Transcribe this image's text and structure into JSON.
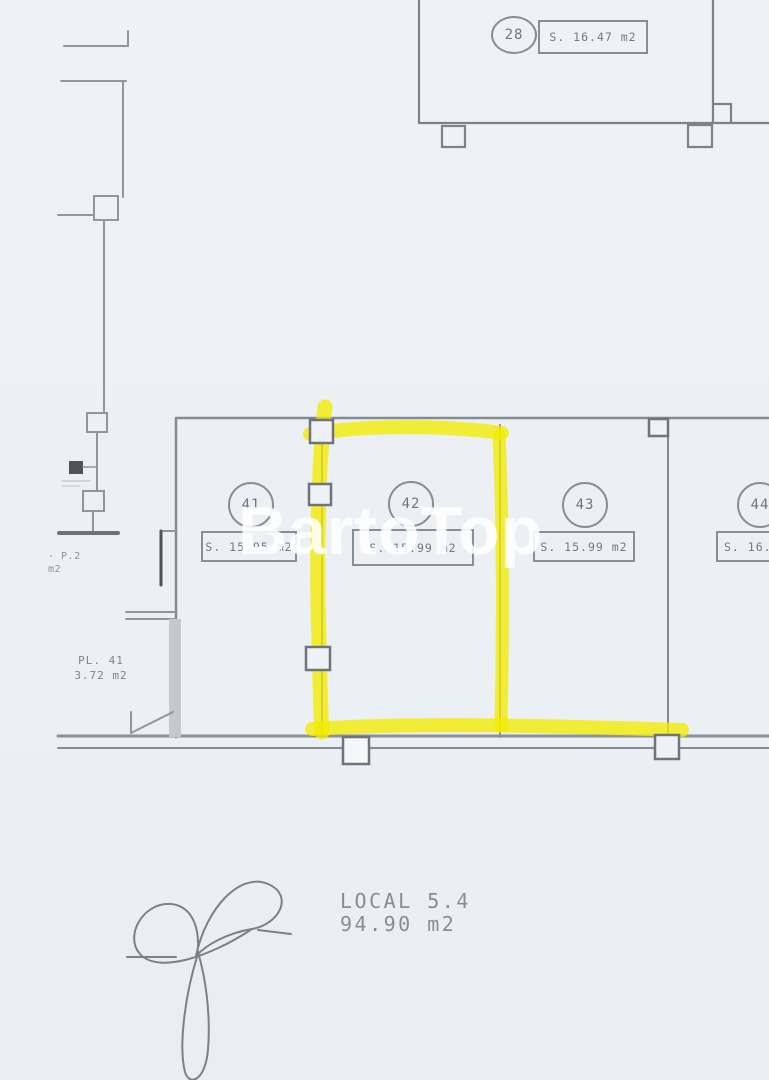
{
  "page": {
    "type": "scanned floor plan",
    "background_color": "#edf1f5",
    "line_color": "#8f969c",
    "highlight_color": "#f2ee00"
  },
  "watermark": {
    "text": "BartoTop"
  },
  "top_unit": {
    "number": "28",
    "area": "S. 16.47 m2"
  },
  "units": [
    {
      "number": "41",
      "area": "S. 15.95 m2",
      "highlighted": false
    },
    {
      "number": "42",
      "area": "S. 15.99 m2",
      "highlighted": true
    },
    {
      "number": "43",
      "area": "S. 15.99 m2",
      "highlighted": false
    },
    {
      "number": "44",
      "area": "S. 16.47 m2",
      "highlighted": false
    }
  ],
  "annotations": {
    "left_upper": {
      "line1": "· P.2",
      "line2": "m2"
    },
    "left_room": {
      "line1": "PL. 41",
      "line2": "3.72 m2"
    },
    "bottom": {
      "line1": "LOCAL 5.4",
      "line2": "94.90 m2"
    }
  }
}
